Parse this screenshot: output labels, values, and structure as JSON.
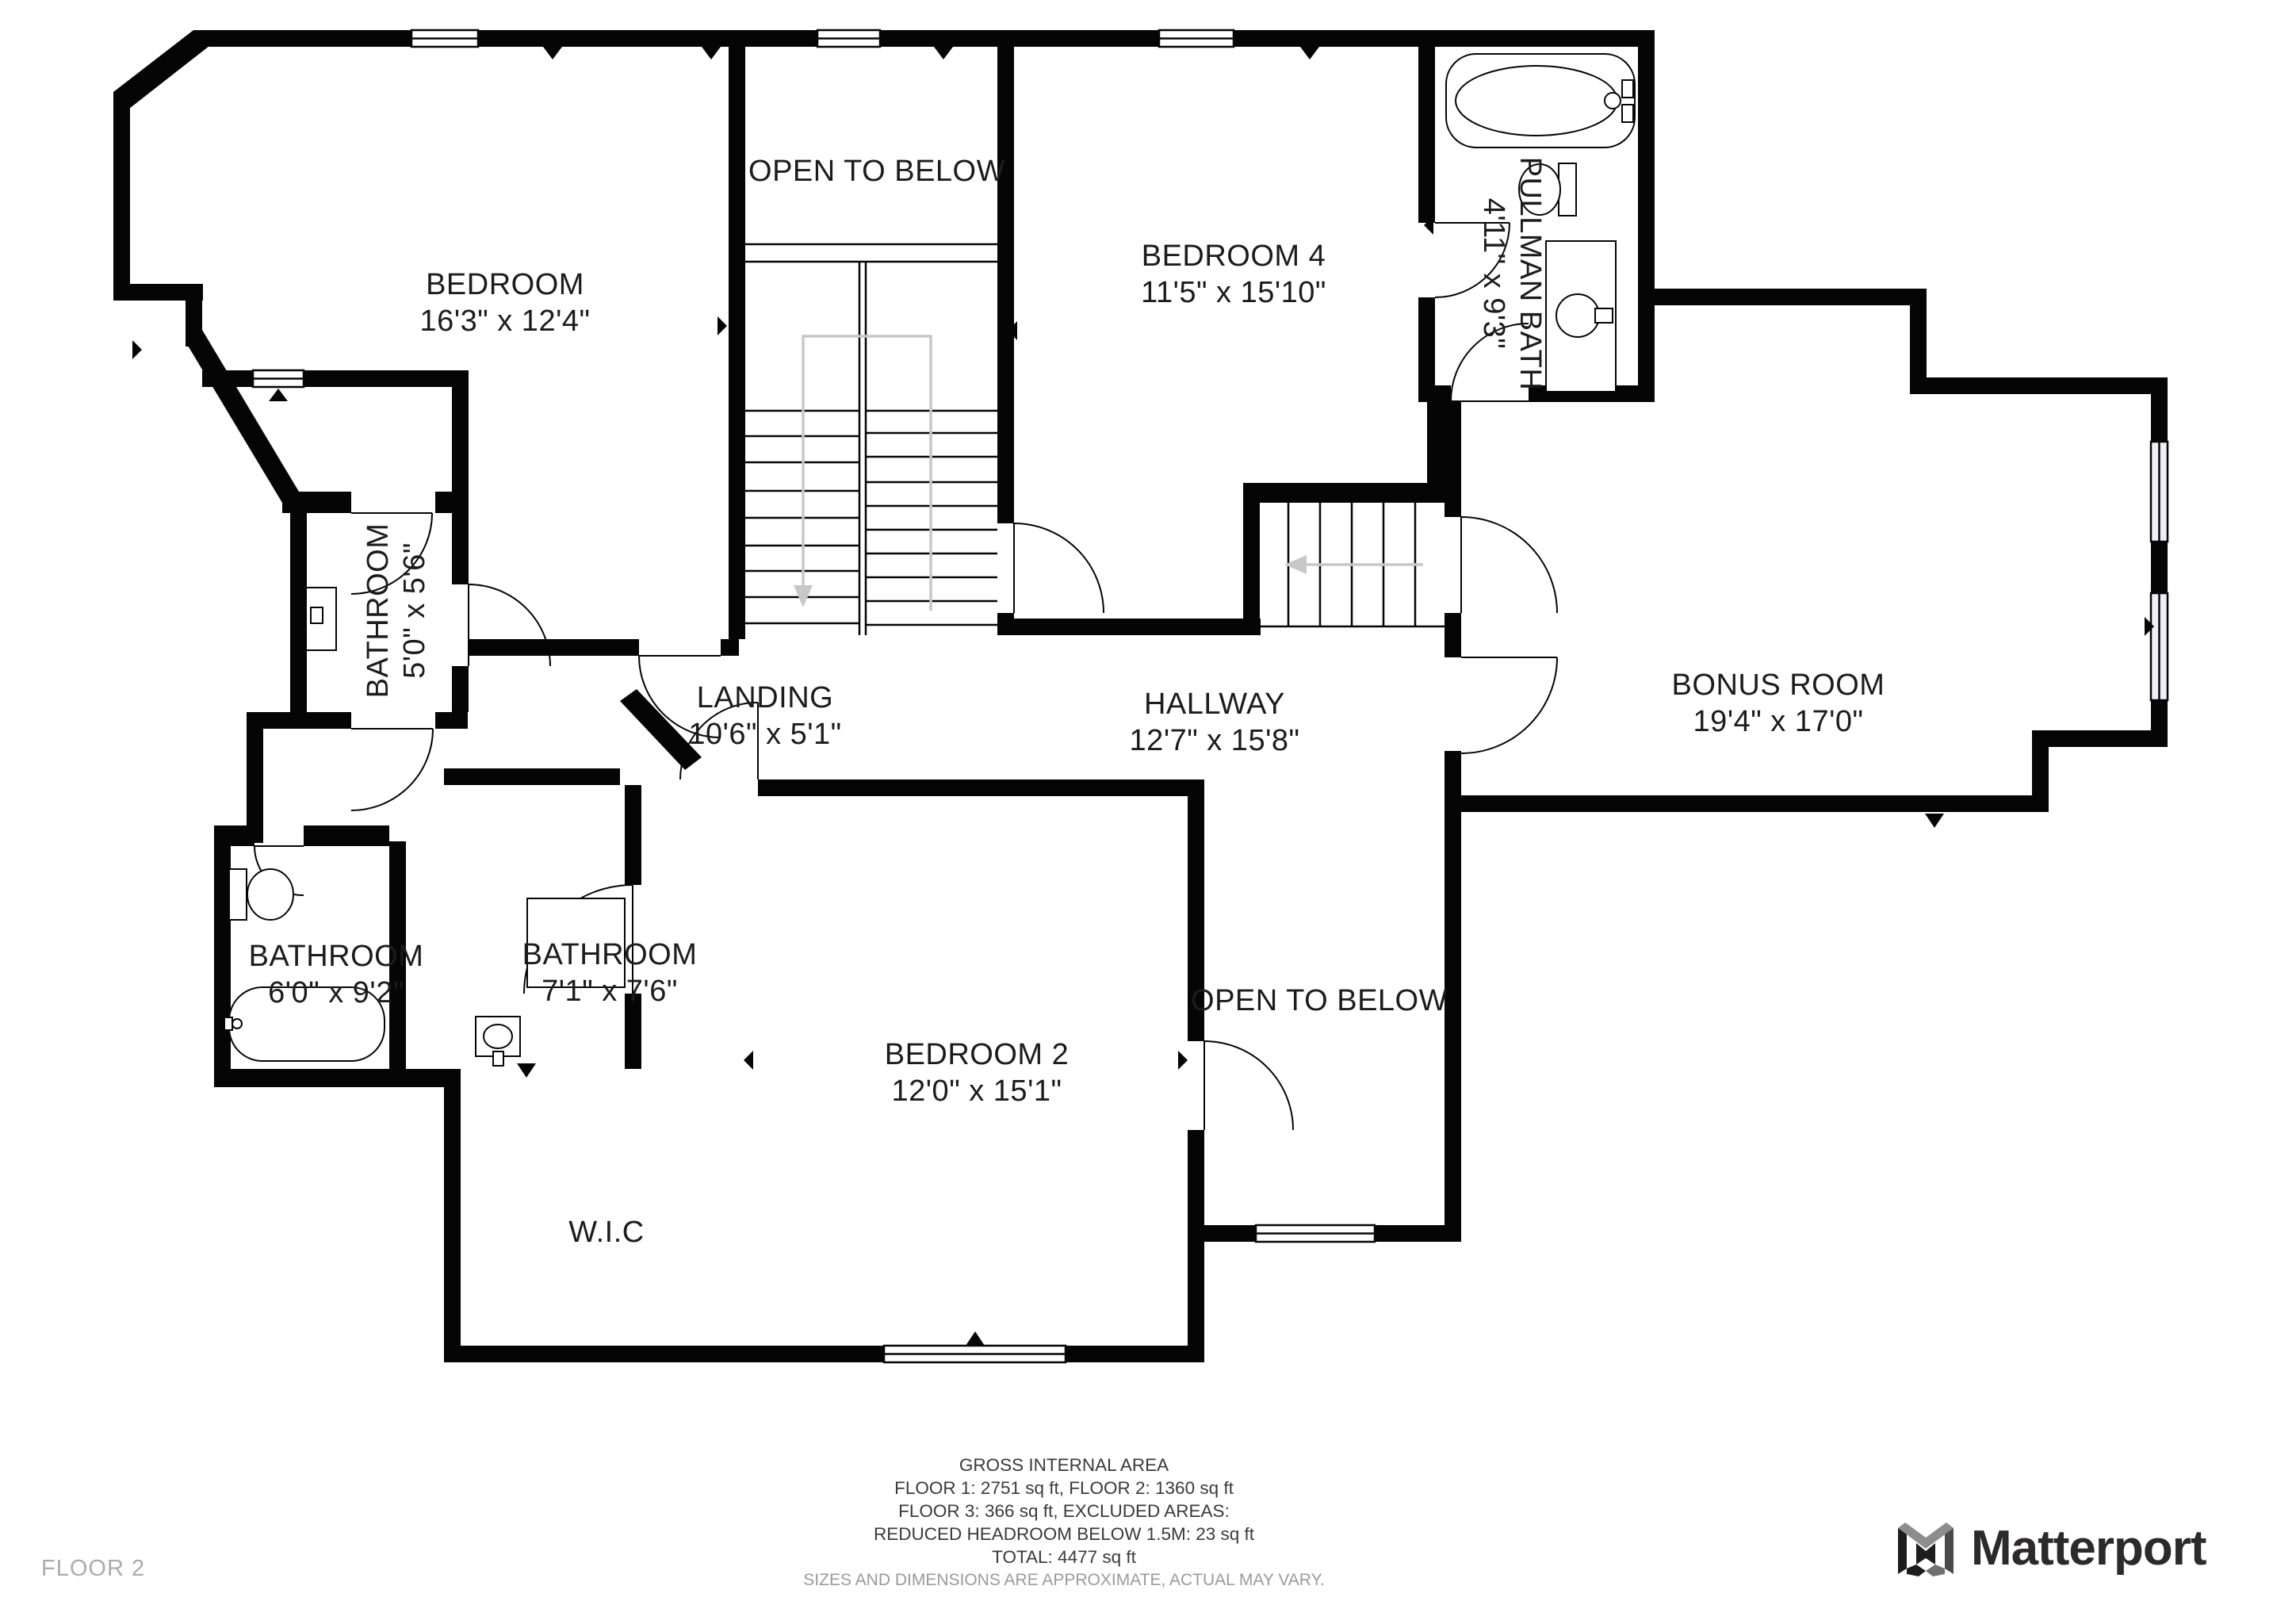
{
  "floor_label": "FLOOR 2",
  "brand": {
    "name": "Matterport"
  },
  "rooms": [
    {
      "name": "BEDROOM",
      "dims": "16'3\" x 12'4\""
    },
    {
      "name": "OPEN TO BELOW",
      "dims": ""
    },
    {
      "name": "BEDROOM 4",
      "dims": "11'5\" x 15'10\""
    },
    {
      "name": "PULLMAN BATH",
      "dims": "4'11\" x 9'3\""
    },
    {
      "name": "BONUS ROOM",
      "dims": "19'4\" x 17'0\""
    },
    {
      "name": "BATHROOM",
      "dims": "5'0\" x 5'6\""
    },
    {
      "name": "LANDING",
      "dims": "10'6\" x 5'1\""
    },
    {
      "name": "HALLWAY",
      "dims": "12'7\" x 15'8\""
    },
    {
      "name": "BATHROOM",
      "dims": "6'0\" x 9'2\""
    },
    {
      "name": "BATHROOM",
      "dims": "7'1\" x 7'6\""
    },
    {
      "name": "BEDROOM 2",
      "dims": "12'0\" x 15'1\""
    },
    {
      "name": "OPEN TO BELOW",
      "dims": ""
    },
    {
      "name": "W.I.C",
      "dims": ""
    }
  ],
  "footer": {
    "lines": [
      "GROSS INTERNAL AREA",
      "FLOOR 1: 2751 sq ft, FLOOR 2: 1360 sq ft",
      "FLOOR 3: 366 sq ft, EXCLUDED AREAS:",
      "REDUCED HEADROOM BELOW 1.5M: 23 sq ft",
      "TOTAL: 4477 sq ft",
      "SIZES AND DIMENSIONS ARE APPROXIMATE, ACTUAL MAY VARY."
    ]
  },
  "colors": {
    "walls": "#050505",
    "window_tint": "#edeef9",
    "guide_gray": "#c8c8c8",
    "muted_text": "#9a9a9a",
    "floor_label_text": "#ababab",
    "brand_text": "#2d2a2b"
  }
}
